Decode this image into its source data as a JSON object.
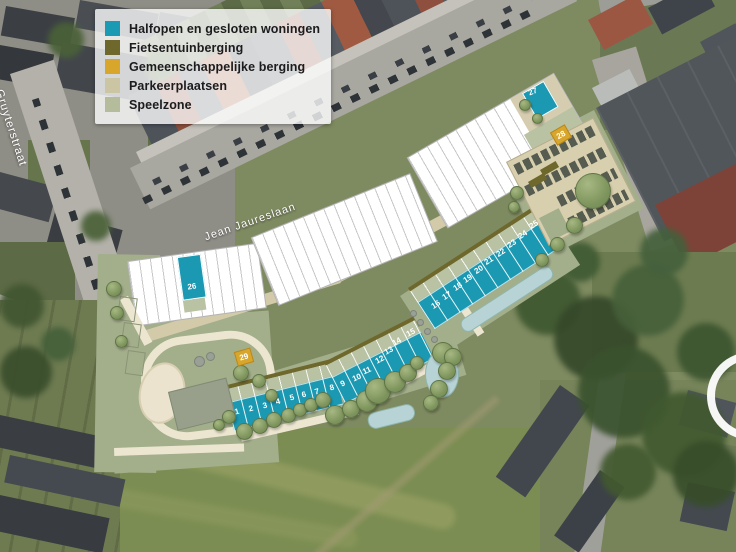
{
  "legend": {
    "items": [
      {
        "label": "Halfopen en gesloten woningen",
        "color": "#1b9ab3"
      },
      {
        "label": "Fietsentuinberging",
        "color": "#6f682c"
      },
      {
        "label": "Gemeenschappelijke berging",
        "color": "#d9a62c"
      },
      {
        "label": "Parkeerplaatsen",
        "color": "#cbc5a4"
      },
      {
        "label": "Speelzone",
        "color": "#b4bc9c"
      }
    ]
  },
  "streets": {
    "left": "Gruyterstraat",
    "main": "Jean Jaureslaan"
  },
  "lots": [
    {
      "n": "1",
      "x": 237,
      "y": 412,
      "r": -14
    },
    {
      "n": "2",
      "x": 251,
      "y": 409,
      "r": -14
    },
    {
      "n": "3",
      "x": 265,
      "y": 406,
      "r": -14
    },
    {
      "n": "4",
      "x": 278,
      "y": 402,
      "r": -14
    },
    {
      "n": "5",
      "x": 292,
      "y": 398,
      "r": -14
    },
    {
      "n": "6",
      "x": 304,
      "y": 395,
      "r": -14
    },
    {
      "n": "7",
      "x": 317,
      "y": 392,
      "r": -14
    },
    {
      "n": "8",
      "x": 332,
      "y": 388,
      "r": -14
    },
    {
      "n": "9",
      "x": 343,
      "y": 384,
      "r": -24
    },
    {
      "n": "10",
      "x": 357,
      "y": 378,
      "r": -24
    },
    {
      "n": "11",
      "x": 367,
      "y": 371,
      "r": -24
    },
    {
      "n": "12",
      "x": 380,
      "y": 360,
      "r": -28
    },
    {
      "n": "13",
      "x": 389,
      "y": 351,
      "r": -28
    },
    {
      "n": "14",
      "x": 397,
      "y": 342,
      "r": -28
    },
    {
      "n": "15",
      "x": 411,
      "y": 333,
      "r": -28
    },
    {
      "n": "16",
      "x": 436,
      "y": 305,
      "r": -33
    },
    {
      "n": "17",
      "x": 447,
      "y": 296,
      "r": -33
    },
    {
      "n": "18",
      "x": 458,
      "y": 287,
      "r": -33
    },
    {
      "n": "19",
      "x": 468,
      "y": 279,
      "r": -33
    },
    {
      "n": "20",
      "x": 479,
      "y": 270,
      "r": -33
    },
    {
      "n": "21",
      "x": 489,
      "y": 261,
      "r": -33
    },
    {
      "n": "22",
      "x": 501,
      "y": 253,
      "r": -33
    },
    {
      "n": "23",
      "x": 512,
      "y": 244,
      "r": -33
    },
    {
      "n": "24",
      "x": 523,
      "y": 235,
      "r": -33
    },
    {
      "n": "25",
      "x": 534,
      "y": 225,
      "r": -33
    },
    {
      "n": "26",
      "x": 192,
      "y": 287,
      "r": -8
    },
    {
      "n": "27",
      "x": 533,
      "y": 92,
      "r": -22
    }
  ],
  "storage_markers": [
    {
      "n": "28",
      "x": 561,
      "y": 135,
      "r": -30
    },
    {
      "n": "29",
      "x": 244,
      "y": 357,
      "r": -16
    }
  ],
  "plan_colors": {
    "housing_teal": "#1b98b2",
    "bike_shed_olive": "#6f682c",
    "common_storage_gold": "#d9a62c",
    "parking_beige": "#d7cfae",
    "playzone_green": "#a3ae8b",
    "path_cream": "#ece6d0",
    "pond_blue": "#b7d3d6",
    "existing_block_white": "#ffffff"
  }
}
